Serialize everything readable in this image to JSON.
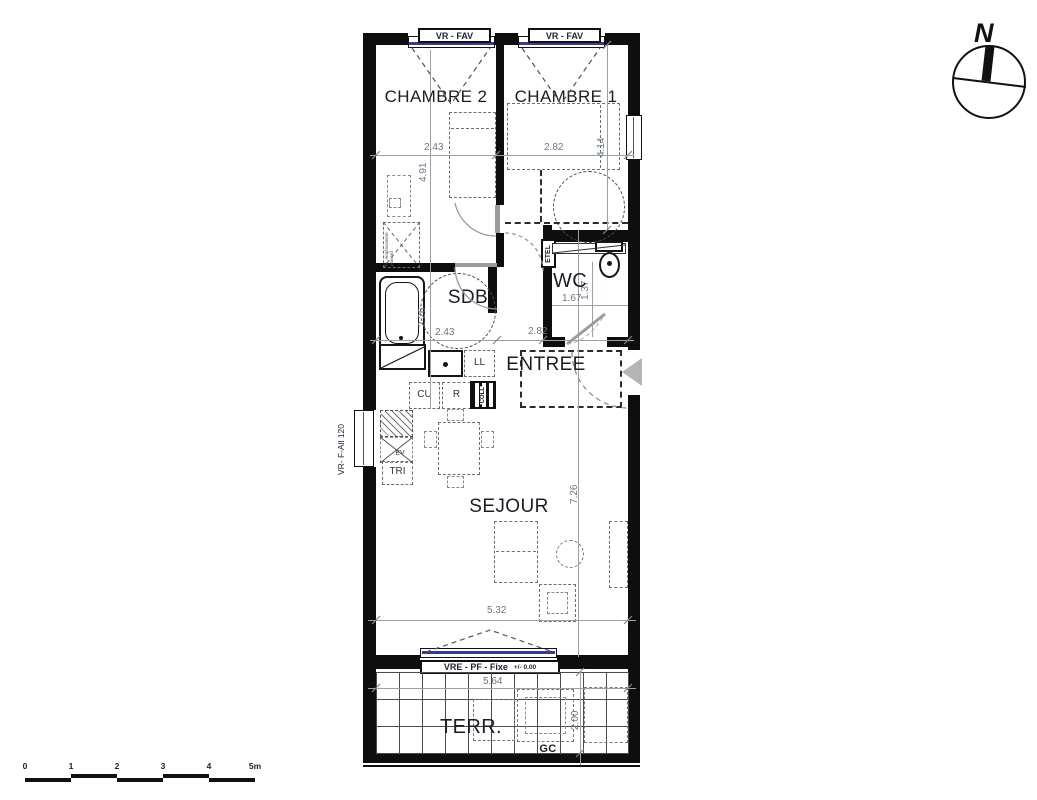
{
  "plan": {
    "rooms": {
      "chambre2": "CHAMBRE 2",
      "chambre1": "CHAMBRE 1",
      "sdb": "SDB",
      "wc": "WC",
      "entree": "ENTREE",
      "sejour": "SEJOUR",
      "terrasse": "TERR."
    },
    "windows": {
      "chambre2_window": "VR - FAV",
      "chambre1_window": "VR - FAV",
      "sejour_window": "VRE - PF - Fixe",
      "sejour_window_level": "+/- 0.00",
      "kitchen_window": "VR- F-All 120"
    },
    "labels": {
      "etel": "ETEL",
      "coll": "COLL",
      "cu": "CU",
      "r": "R",
      "ll": "LL",
      "ev": "EV",
      "tri": "TRI",
      "gc": "GC",
      "closet_note": "PL emplacement placard"
    },
    "dimensions": {
      "chambre2_width": "2.43",
      "chambre2_depth": "4.91",
      "chambre1_width": "2.82",
      "chambre1_depth": "4.14",
      "sdb_depth": "2.26",
      "sdb_width": "2.43",
      "entree_width": "2.82",
      "wc_width": "1.67",
      "wc_depth": "1.37",
      "sejour_depth": "7.26",
      "sejour_width": "5.32",
      "terrasse_width": "5.64",
      "terrasse_depth": "2.00"
    }
  },
  "compass": {
    "north": "N"
  },
  "scale_bar": {
    "ticks": [
      "0",
      "1",
      "2",
      "3",
      "4",
      "5m"
    ]
  },
  "colors": {
    "wall": "#0e0e0e",
    "glazing": "#3b3b8c",
    "dimension_text": "#6b7585",
    "room_label": "#1c1c26"
  }
}
